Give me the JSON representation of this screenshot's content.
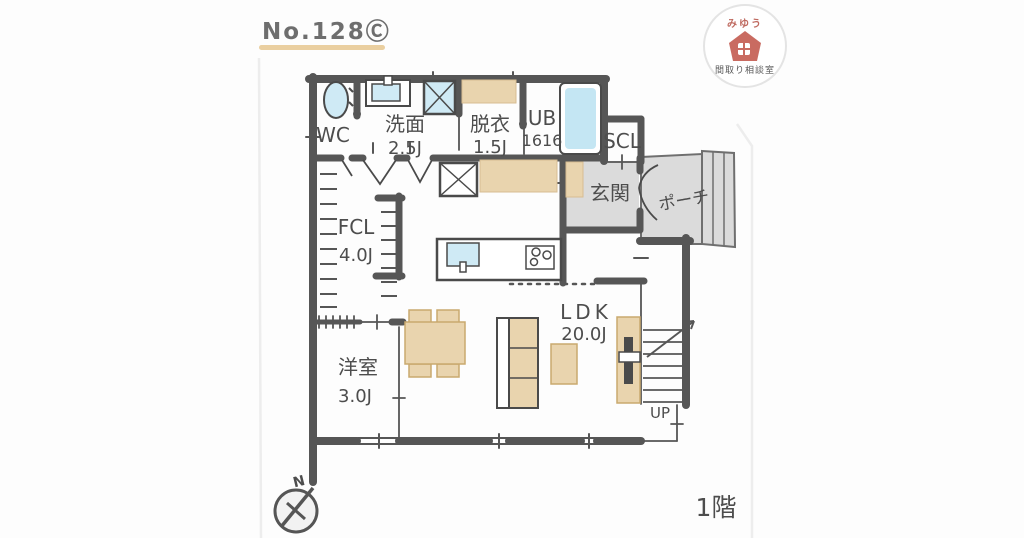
{
  "title": "No.128Ⓒ",
  "logo": {
    "name": "みゆう",
    "subtitle": "間取り相談室"
  },
  "floor_label": "1階",
  "compass": {
    "north": "N"
  },
  "stairs": {
    "direction": "UP"
  },
  "rooms": {
    "wc": {
      "name": "WC"
    },
    "washroom": {
      "name": "洗面",
      "size": "2.5J"
    },
    "dressing": {
      "name": "脱衣",
      "size": "1.5J"
    },
    "bath": {
      "name": "UB",
      "size": "1616"
    },
    "shoe_closet": {
      "name": "SCL"
    },
    "entrance": {
      "name": "玄関"
    },
    "porch": {
      "name": "ポーチ"
    },
    "family_closet": {
      "name": "FCL",
      "size": "4.0J"
    },
    "western_room": {
      "name": "洋室",
      "size": "3.0J"
    },
    "ldk": {
      "name": "LDK",
      "size": "20.0J"
    }
  }
}
